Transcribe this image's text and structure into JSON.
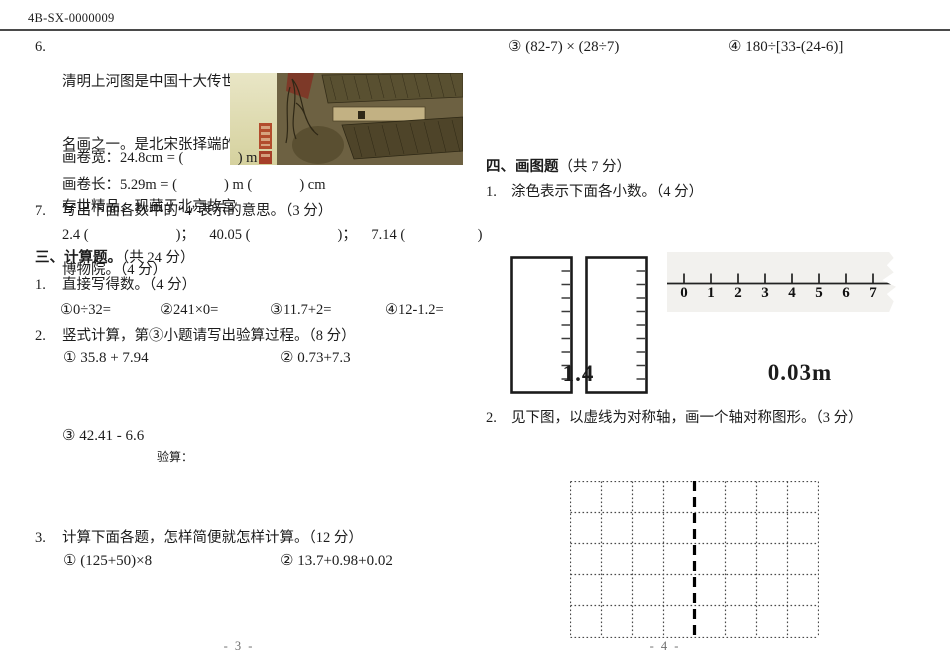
{
  "colors": {
    "paper": "#ffffff",
    "ink": "#1c1c1c",
    "header_rule": "#4a4a4a",
    "grid_line": "#4a4a4a",
    "symmetry_axis": "#000000",
    "ruler_strip_bg": "#f2f1ee",
    "painting_silk": "#ddd9ac",
    "painting_brown": "#6d6142",
    "seal_red": "#b24c2c"
  },
  "header": {
    "doc_code": "4B-SX-0000009"
  },
  "page3": {
    "q6": {
      "number": "6.",
      "lines": [
        "清明上河图是中国十大传世",
        "名画之一。是北宋张择端的",
        "存世精品，现藏于北京故宫",
        "博物院。（4 分）"
      ],
      "width_line": "画卷宽：24.8cm = (               ) m",
      "length_line": "画卷长：5.29m = (             ) m (             ) cm",
      "image_caption": "qingming-scroll-painting"
    },
    "q7": {
      "number": "7.",
      "text": "写出下面各数中的“4”表示的意思。（3 分）",
      "blanks": "2.4 (                        )；    40.05 (                        )；    7.14 (                    )"
    },
    "section3": {
      "title_bold": "三、计算题。",
      "title_rest": "（共 24 分）",
      "item1": {
        "number": "1.",
        "text": "直接写得数。（4 分）",
        "problems": [
          "①0÷32=",
          "②241×0=",
          "③11.7+2=",
          "④12-1.2="
        ]
      },
      "item2": {
        "number": "2.",
        "text": "竖式计算，第③小题请写出验算过程。（8 分）",
        "problems": [
          "① 35.8 + 7.94",
          "② 0.73+7.3"
        ],
        "problem3": "③ 42.41 - 6.6",
        "check_label": "验算："
      },
      "item3": {
        "number": "3.",
        "text": "计算下面各题，怎样简便就怎样计算。（12 分）",
        "problems": [
          "① (125+50)×8",
          "② 13.7+0.98+0.02"
        ]
      }
    },
    "footer": "- 3 -"
  },
  "page4": {
    "calc_problems": [
      "③ (82-7) × (28÷7)",
      "④ 180÷[33-(24-6)]"
    ],
    "section4": {
      "title_bold": "四、画图题",
      "title_rest": "（共 7 分）",
      "item1": {
        "number": "1.",
        "text": "涂色表示下面各小数。（4 分）",
        "decimal_labels": [
          "1.4",
          "0.03m"
        ],
        "number_line_ticks": [
          "0",
          "1",
          "2",
          "3",
          "4",
          "5",
          "6",
          "7"
        ]
      },
      "item2": {
        "number": "2.",
        "text": "见下图，以虚线为对称轴，画一个轴对称图形。（3 分）"
      }
    },
    "footer": "- 4 -"
  }
}
